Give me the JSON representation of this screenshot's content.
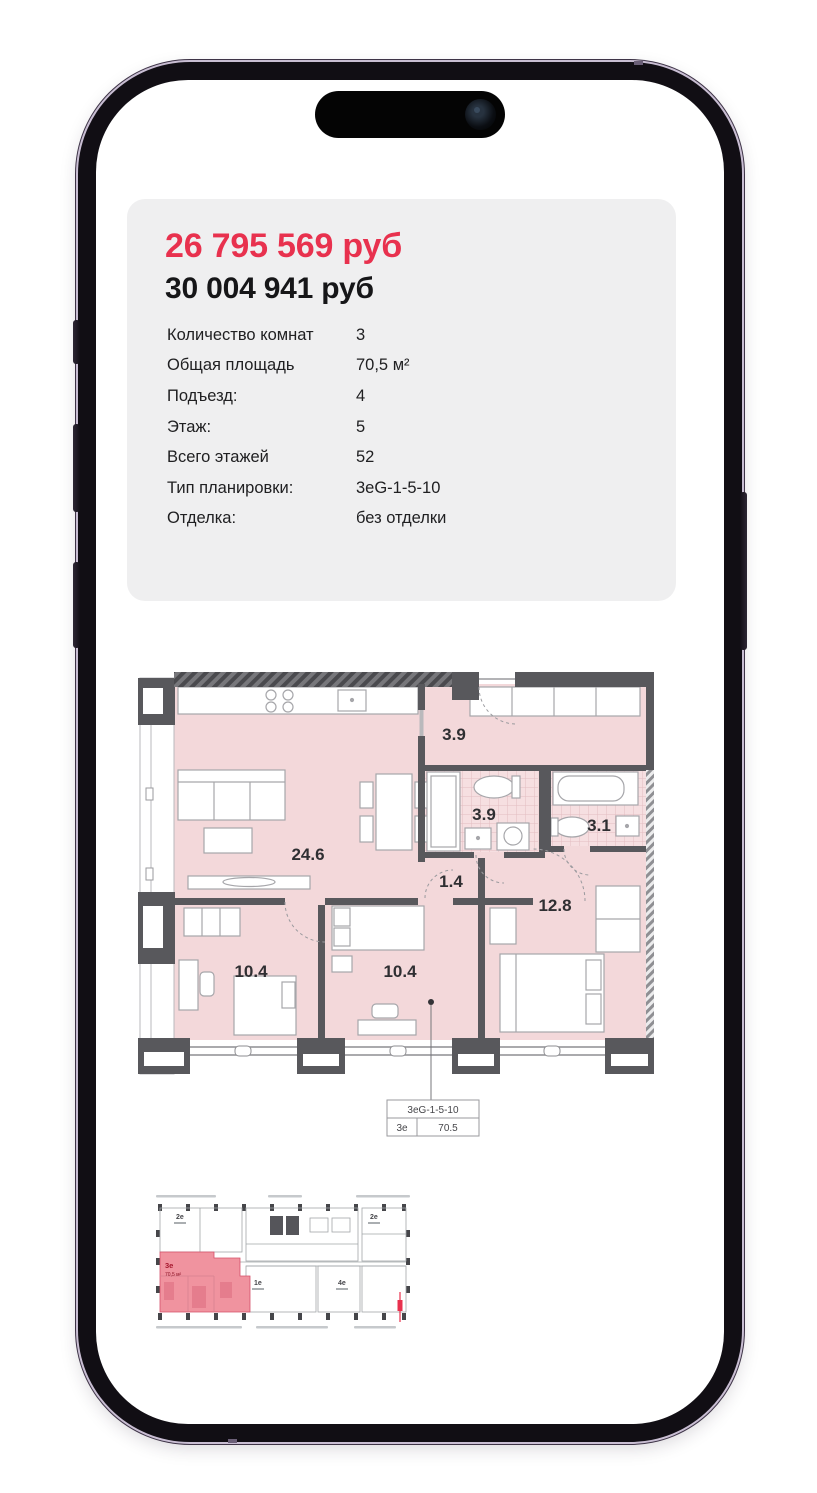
{
  "listing": {
    "price_sale": "26 795 569 руб",
    "price_base": "30 004 941 руб",
    "attributes": [
      {
        "label": "Количество комнат",
        "value": "3"
      },
      {
        "label": "Общая площадь",
        "value": "70,5 м²"
      },
      {
        "label": "Подъезд:",
        "value": "4"
      },
      {
        "label": "Этаж:",
        "value": "5"
      },
      {
        "label": "Всего этажей",
        "value": "52"
      },
      {
        "label": "Тип планировки:",
        "value": "3eG-1-5-10"
      },
      {
        "label": "Отделка:",
        "value": "без отделки"
      }
    ]
  },
  "floor_plan": {
    "areas": {
      "living_kitchen": "24.6",
      "entry_hall": "3.9",
      "bathroom": "3.9",
      "bathroom_small": "3.1",
      "corridor": "1.4",
      "bedroom_main": "12.8",
      "bedroom_left": "10.4",
      "bedroom_middle": "10.4"
    },
    "tag": {
      "layout_code": "3eG-1-5-10",
      "unit_type": "3e",
      "total_area": "70.5"
    }
  },
  "mini_plan": {
    "units": {
      "top_left": "2e",
      "top_right": "2e",
      "selected": "3e",
      "selected_area": "70,5 м²",
      "bottom_middle": "1e",
      "bottom_right": "4e"
    }
  },
  "colors": {
    "accent_red": "#e8314e",
    "plan_room_fill": "#f3d8da",
    "plan_wall": "#58585c",
    "selected_unit_fill": "#f0939f",
    "card_bg": "#efeff0"
  }
}
